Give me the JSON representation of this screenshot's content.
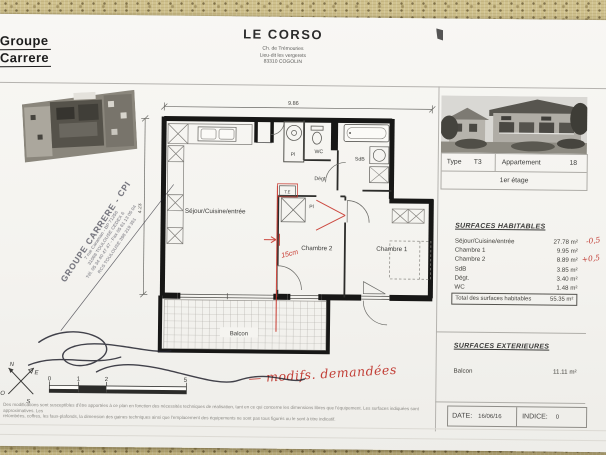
{
  "branding": {
    "company_top": "Groupe",
    "company_bottom": "Carrere"
  },
  "header": {
    "title": "LE CORSO",
    "address1": "Ch. de Trémouries",
    "address2": "Lieu-dit les vergerets",
    "address3": "83310 COGOLIN"
  },
  "unit_info": {
    "type_label": "Type",
    "type_value": "T3",
    "apt_label": "Appartement",
    "apt_value": "18",
    "floor": "1er étage"
  },
  "surfaces_habitables": {
    "title": "SURFACES HABITABLES",
    "rows": [
      {
        "label": "Séjour/Cuisine/entrée",
        "value": "27.78 m²",
        "note": "-0,5"
      },
      {
        "label": "Chambre 1",
        "value": "9.95 m²",
        "note": ""
      },
      {
        "label": "Chambre 2",
        "value": "8.89 m²",
        "note": "+0,5"
      },
      {
        "label": "SdB",
        "value": "3.85 m²",
        "note": ""
      },
      {
        "label": "Dégt.",
        "value": "3.40 m²",
        "note": ""
      },
      {
        "label": "WC",
        "value": "1.48 m²",
        "note": ""
      }
    ],
    "total_label": "Total des surfaces habitables",
    "total_value": "55.35 m²"
  },
  "surfaces_exterieures": {
    "title": "SURFACES EXTERIEURES",
    "rows": [
      {
        "label": "Balcon",
        "value": "11.11 m²"
      }
    ]
  },
  "footer": {
    "date_label": "DATE:",
    "date_value": "16/06/16",
    "indice_label": "INDICE:",
    "indice_value": "0",
    "disclaimer1": "Des modifications sont susceptibles d'être apportées à ce plan en fonction des nécessités techniques de réalisation, tant en ce qui concerne les dimensions libres que l'équipement. Les surfaces indiquées sont approximatives. Les",
    "disclaimer2": "retombées, coffres, les faux-plafonds, la dimension des gaines techniques ainsi que l'emplacement des équipements ne sont pas tous figurés ou le sont à titre indicatif."
  },
  "plan": {
    "dim_width": "9.86",
    "dim_height": "4.23",
    "rooms": {
      "sejour": "Séjour/Cuisine/entrée",
      "chambre2": "Chambre 2",
      "chambre1": "Chambre 1",
      "wc": "WC",
      "sdb": "SdB",
      "degt": "Dégt.",
      "pl1": "Pl",
      "pl2": "Pl",
      "te": "T.E",
      "balcon": "Balcon"
    },
    "scale_ticks": [
      "0",
      "1",
      "2",
      "5"
    ],
    "compass": {
      "n": "N",
      "e": "E",
      "s": "S",
      "o": "O"
    }
  },
  "annotations": {
    "wall_shift": "15cm",
    "request_note": "— modifs. demandées",
    "red_color": "#c23e36"
  },
  "stamp": {
    "line1": "GROUPE CARRERE - CPI",
    "line2": "7 rue Caraman - BP 71256",
    "line3": "31068 TOULOUSE CEDEX 6",
    "line4": "Tél. 05 34 40 47 47 - Fax 05 61 13 05 04",
    "line5": "RCS TOULOUSE 398 219 351"
  }
}
